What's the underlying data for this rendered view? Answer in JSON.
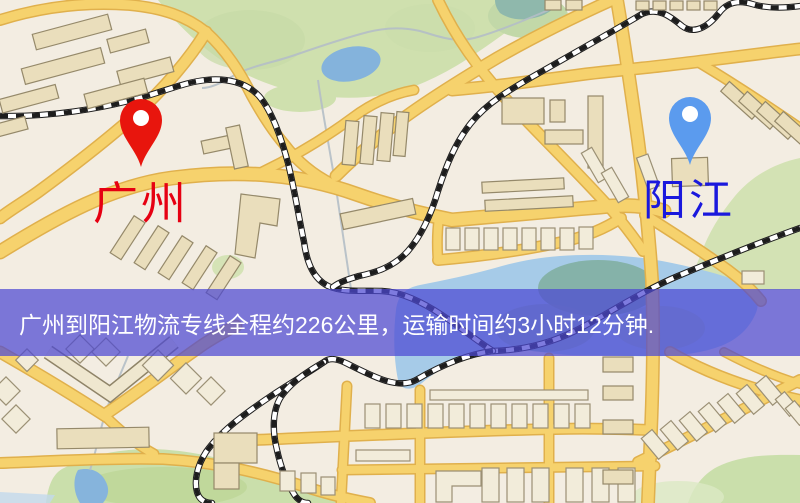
{
  "map": {
    "origin": {
      "label": "广州",
      "pin_color": "#e8150d",
      "label_color": "#e60012"
    },
    "destination": {
      "label": "阳江",
      "pin_color": "#5b9bee",
      "label_color": "#1a18dd"
    },
    "banner": {
      "text": "广州到阳江物流专线全程约226公里，运输时间约3小时12分钟.",
      "background": "#4c48d2",
      "text_color": "#ffffff"
    },
    "route": {
      "distance_text": "约226公里",
      "duration_text": "约3小时12分钟"
    },
    "palette": {
      "map_background": "#f3ede2",
      "road": "#f6d26d",
      "road_casing": "#e0b04c",
      "railway": "#1d1d1d",
      "park": "#cfe0ae",
      "water": "#a6cbe8",
      "building": "#eadebc"
    }
  }
}
